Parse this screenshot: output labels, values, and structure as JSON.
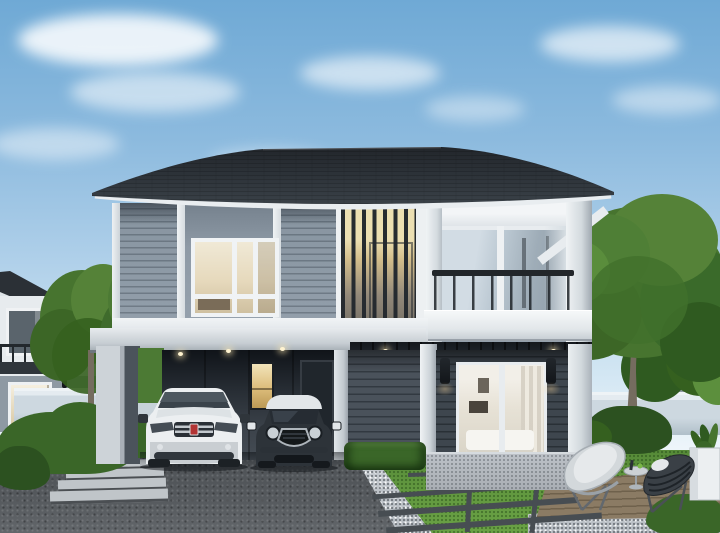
{
  "canvas": {
    "width": 720,
    "height": 533
  },
  "scene": {
    "type": "exterior-architectural-render",
    "subject": "modern two-storey detached house, daytime",
    "no_visible_text": true,
    "elements": [
      "blue sky with wispy clouds",
      "dark grey hip roof with flared eaves and white fascia",
      "upper floor grey lap siding with bedroom window",
      "vertical timber slat screen with warm interior light",
      "balcony with white frame, sliding glass window and black-framed glass railing",
      "open carport with white SUV and black mini hatchback",
      "narrow lit window and door on carport back wall",
      "recessed porch with white sliding glass door showing living room",
      "two black wall sconces",
      "stone plinth base",
      "dark speckled driveway",
      "white gravel strip",
      "lawn panels with dark paver strips",
      "timber deck with two designer lounge chairs, side table and white planter",
      "clipped hedges and round bushes",
      "light grey boundary fence walls",
      "neighbouring two-storey houses at left and right edges",
      "large green trees"
    ]
  },
  "colors": {
    "sky_top": "#6fa9d5",
    "sky_pale": "#edf5fa",
    "cloud": "#ffffff",
    "roof": "#2b3036",
    "fascia": "#e9edf0",
    "siding_upper": "#94a0ac",
    "panel_upper": "#8e9aa6",
    "window_warm": "#e6d9bc",
    "slat_glow": "#ecdfb2",
    "slat_dark": "#262b30",
    "glass_blue": "#bcc9d3",
    "glass_blue_deep": "#8f9ca7",
    "railing": "#22262a",
    "band_white": "#f1f4f6",
    "soffit": "#14181d",
    "siding_lower": "#4a525b",
    "siding_lower_dark": "#3e464e",
    "carport_dark": "#101419",
    "carport_wall": "#3d444c",
    "warm_light": "#ddbd7b",
    "door_dark": "#20262c",
    "glassdoor_interior": "#e9e4da",
    "sconce": "#121519",
    "plinth": "#bcc1c7",
    "drive": "#54585c",
    "gravel": "#c9ced3",
    "walkway": "#c0c5c9",
    "lawn": "#61973f",
    "lawn_dark": "#47772c",
    "paver": "#474d52",
    "deck": "#8b7b64",
    "deck_line": "#6f614c",
    "hedge": "#3a6628",
    "hedge_dark": "#2c5120",
    "tree_mid": "#47742f",
    "tree_dark": "#35601f",
    "tree_light": "#558238",
    "tree_bright": "#5c8f3d",
    "trunk": "#756c5f",
    "fence": "#cdd8e0",
    "fence_cap": "#eef3f6",
    "fence_shade": "#b0bfc9",
    "neighbor_wall": "#e7ebee",
    "neighbor_gray": "#8e99a3",
    "suv_body": "#e8ebed",
    "mini_body": "#2d3339",
    "mini_roof": "#e2e6e9",
    "car_glass": "#3a434b",
    "chrome": "#c3c9ce",
    "badge_red": "#b23434"
  }
}
